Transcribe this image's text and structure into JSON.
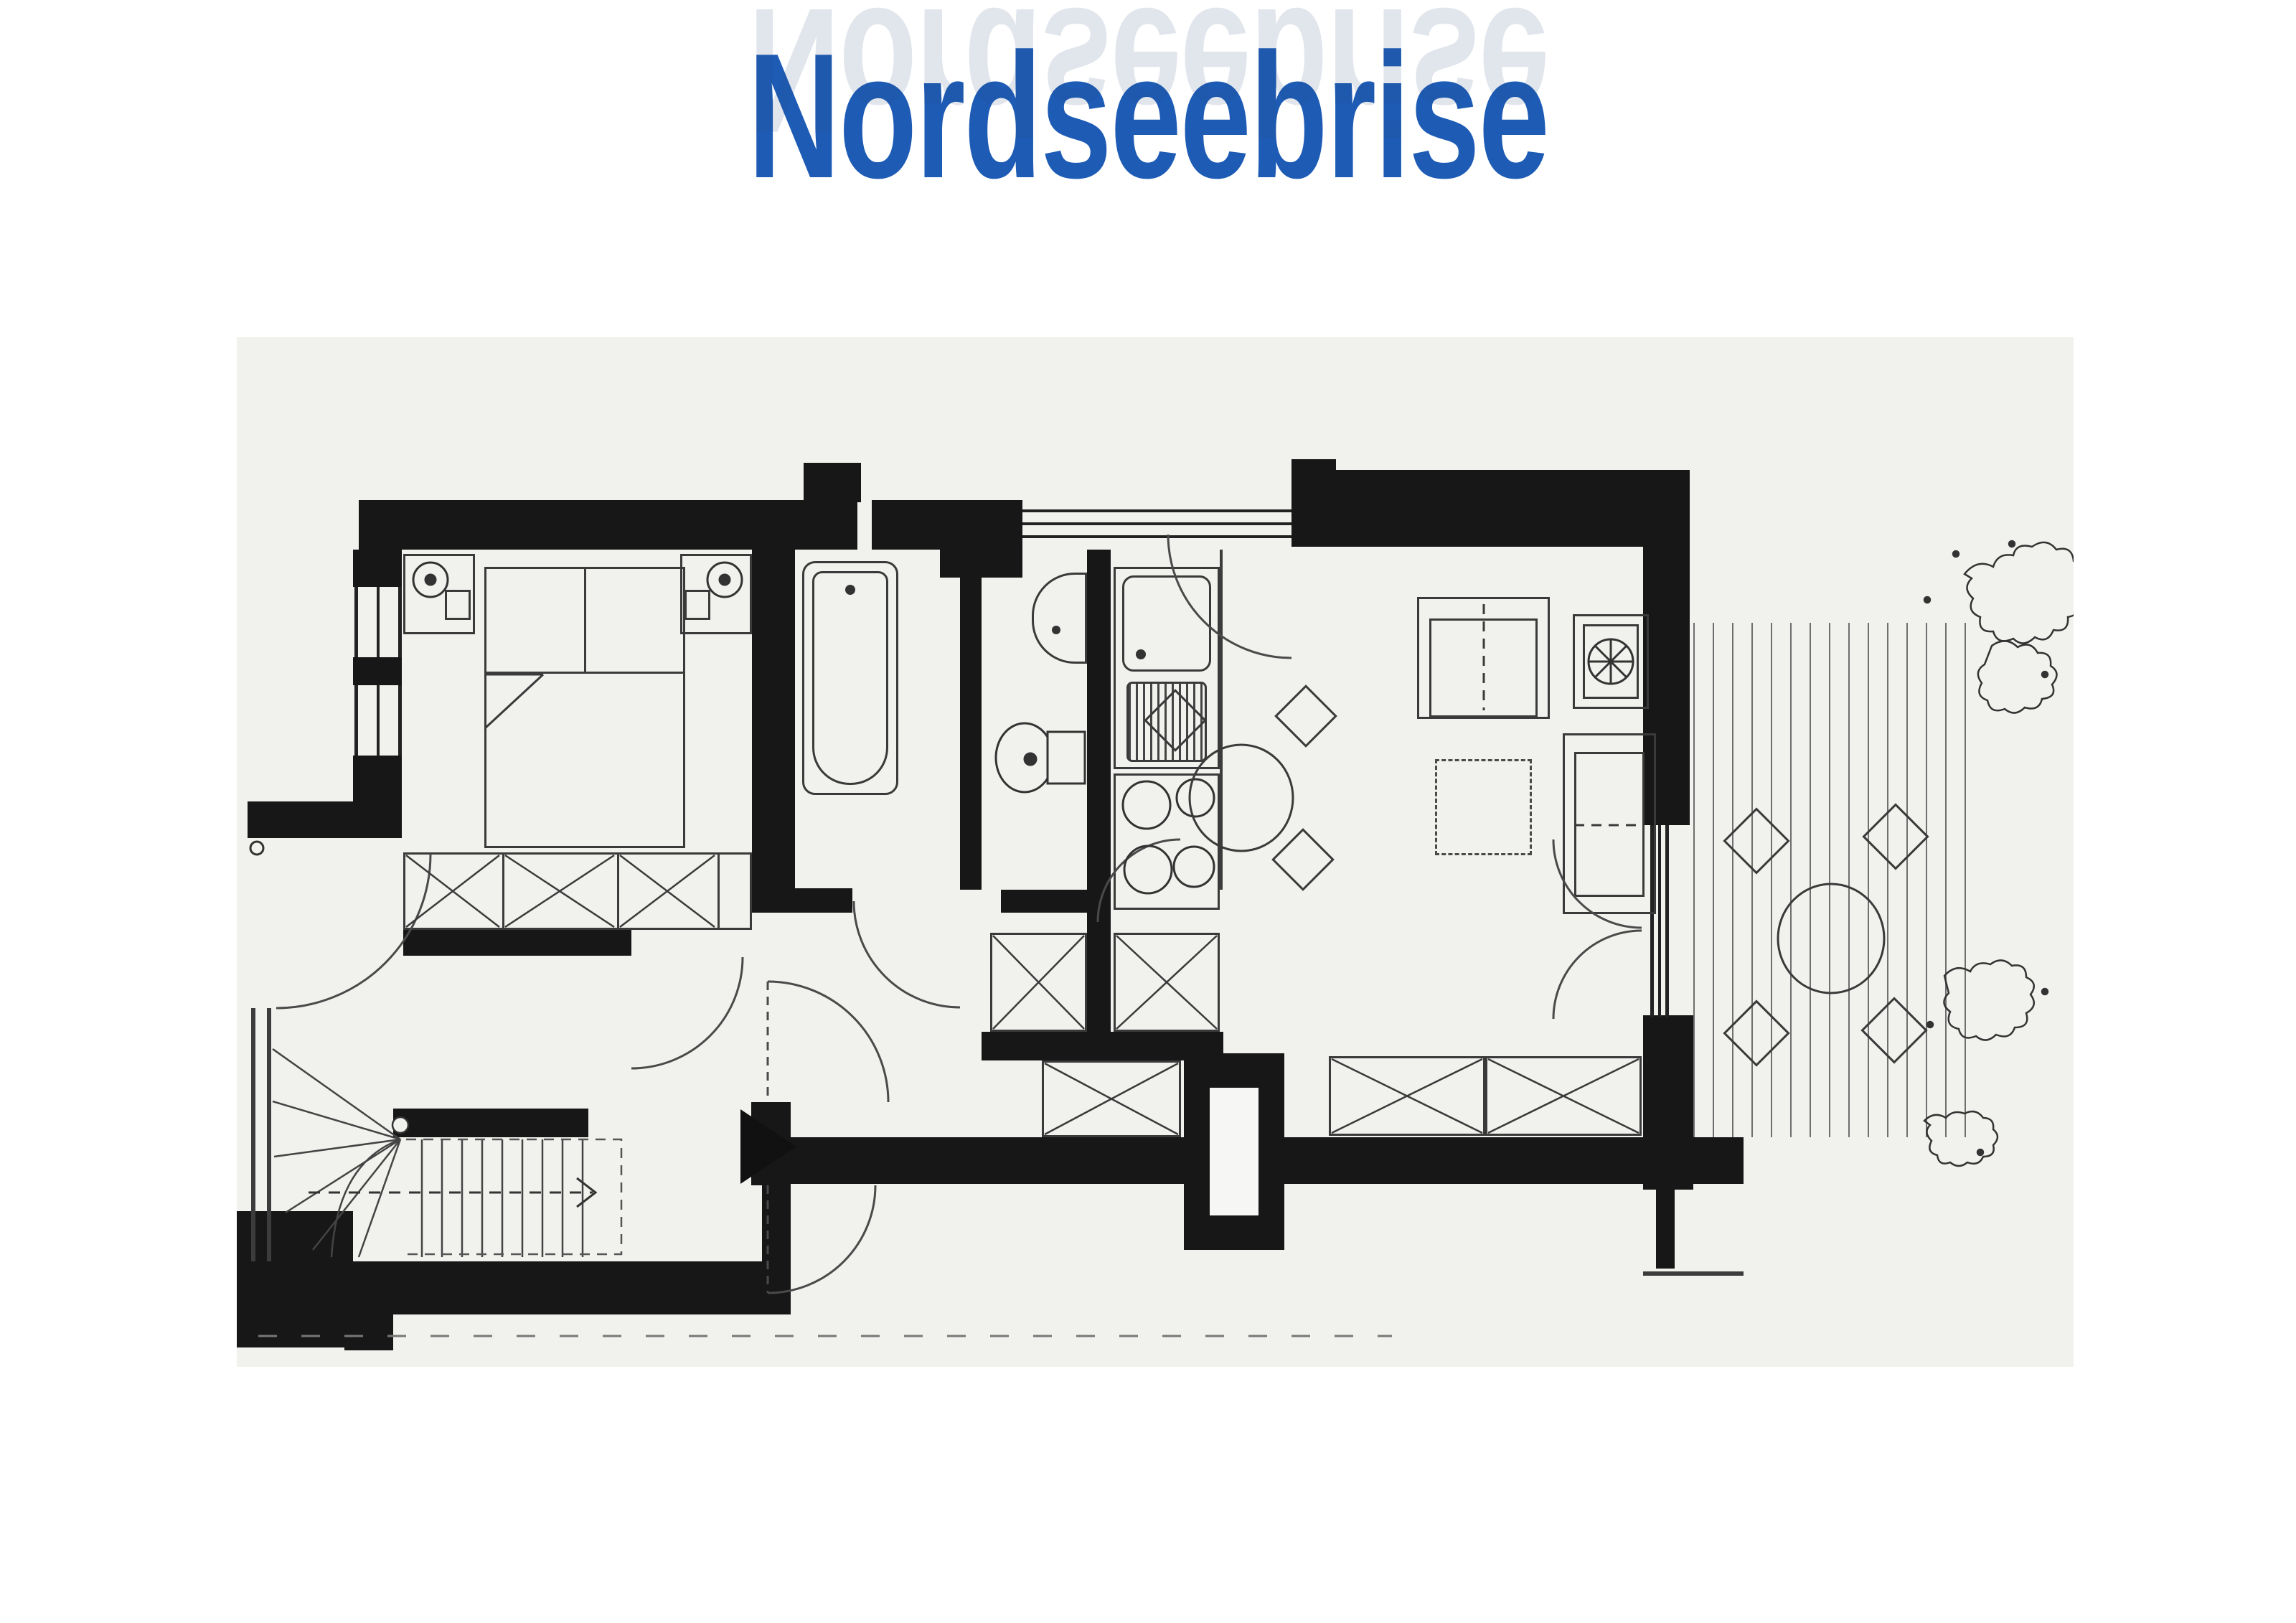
{
  "title": {
    "text": "Nordseebrise",
    "color": "#1d5bb5"
  },
  "reflection": {
    "text": "Nordseebrise"
  },
  "palette": {
    "title_blue": "#1d5bb5",
    "wall_black": "#171717",
    "drawing_line": "#3c3c3c",
    "paper": "#f1f1ee",
    "page_background": "#ffffff"
  },
  "plan": {
    "type": "apartment-floorplan",
    "rooms": [
      "bedroom",
      "bathroom",
      "wc",
      "kitchen",
      "entrance-hall",
      "stairwell",
      "living-dining-room",
      "terrace"
    ],
    "furniture_symbols": [
      "double-bed",
      "nightstand-left",
      "nightstand-right",
      "wardrobe",
      "bathtub",
      "washbasin",
      "toilet",
      "kitchen-sink",
      "stove",
      "kitchen-cabinets",
      "sofa",
      "tv-cabinet",
      "coffee-table",
      "armchair",
      "dining-table",
      "dining-chairs",
      "sideboard",
      "terrace-table",
      "terrace-chairs",
      "winder-staircase",
      "entrance-arrow",
      "service-shaft",
      "deck-boards",
      "plants"
    ]
  }
}
